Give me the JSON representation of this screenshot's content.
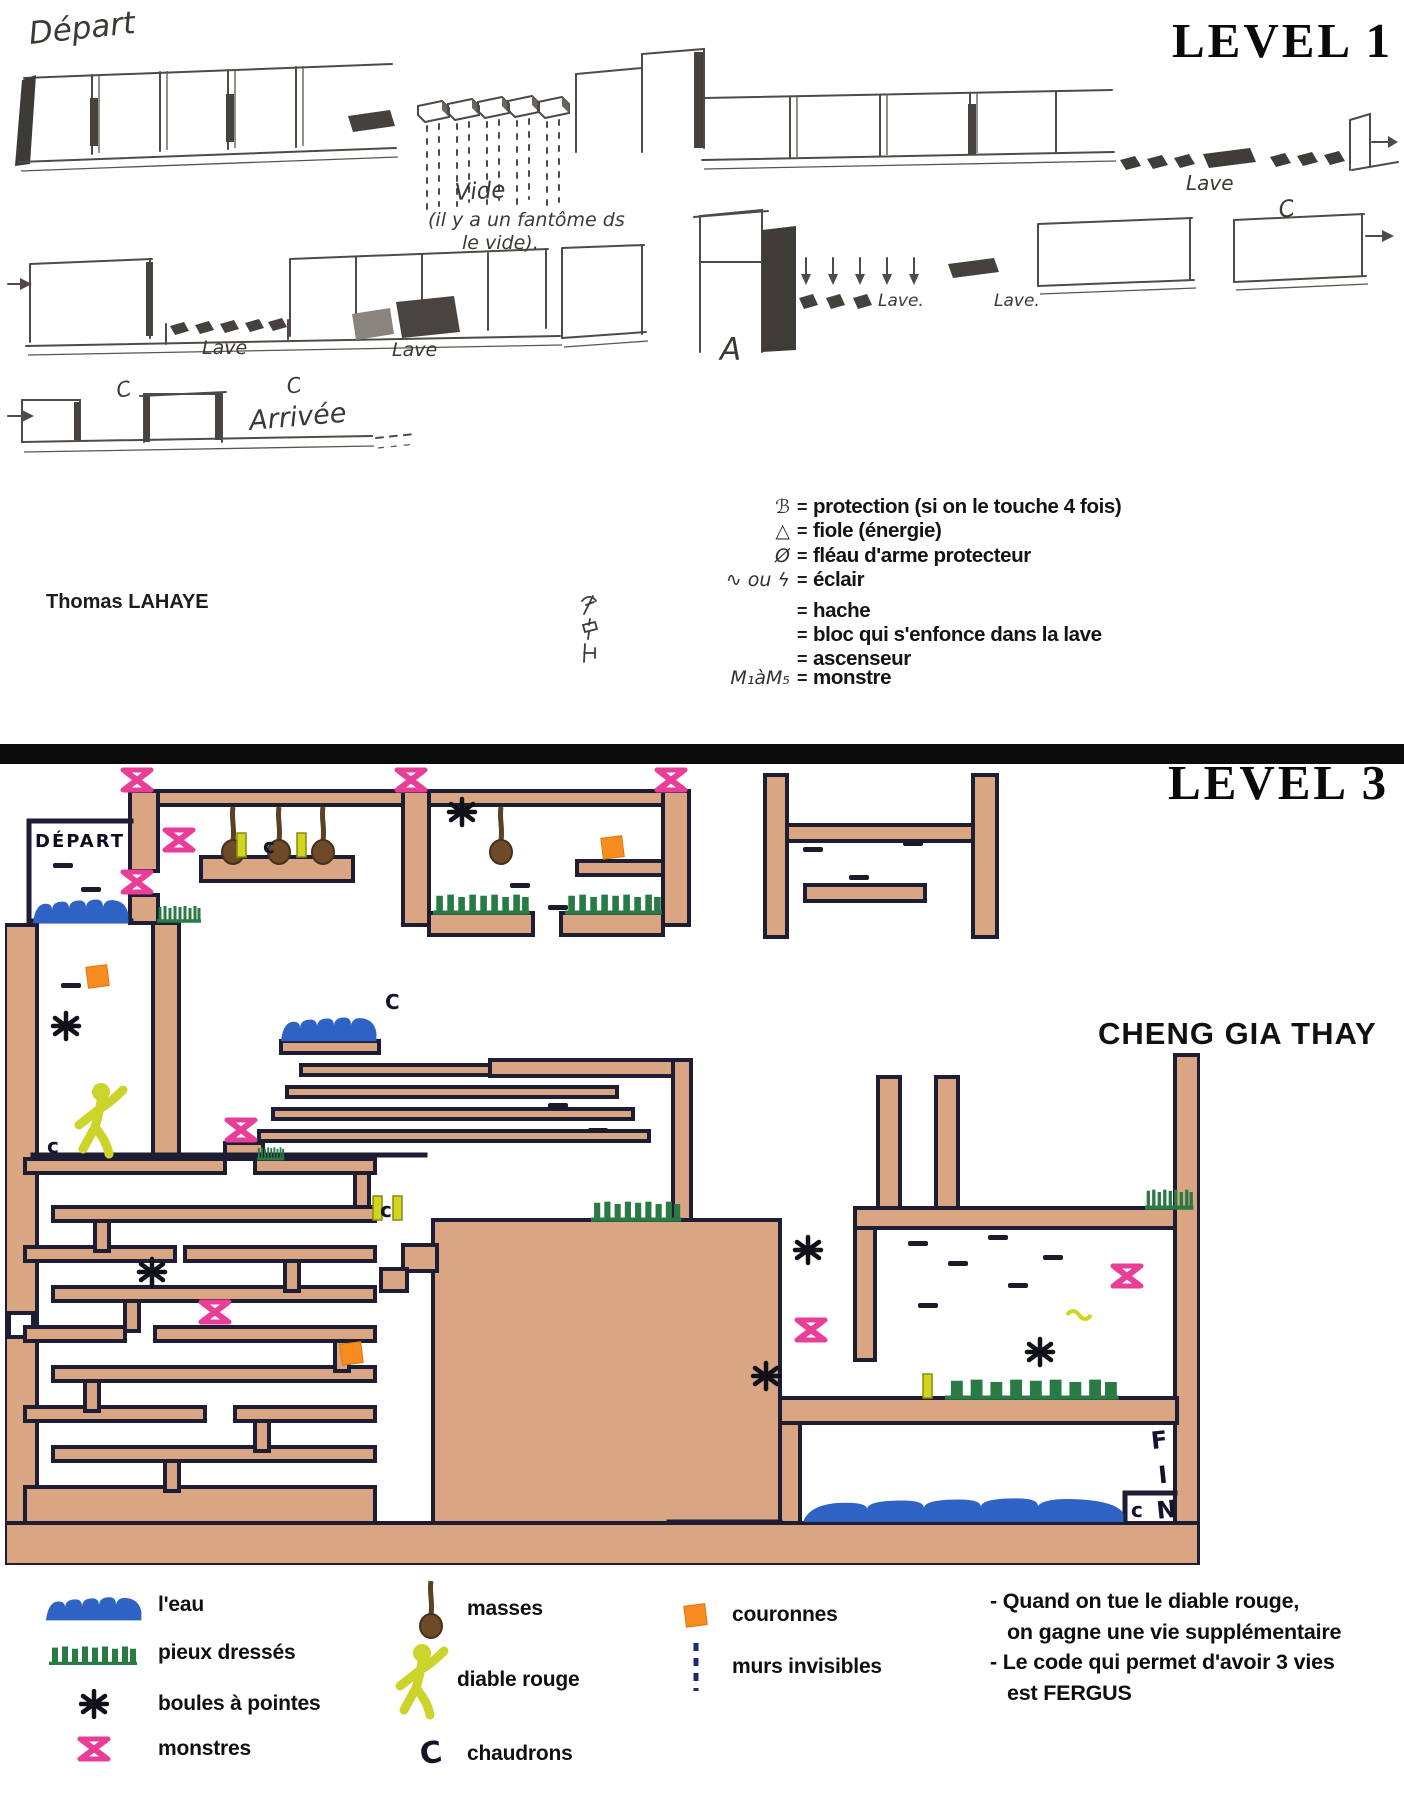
{
  "palette": {
    "wall_tan": "#d9a583",
    "ink_outline": "#1d1d33",
    "pencil_gray": "#4f4a45",
    "monster_pink": "#e93e97",
    "spikes_green": "#2a7a45",
    "water_blue": "#2e62c5",
    "crown_orange": "#f68b20",
    "devil_yellow": "#ccd32b",
    "mace_brown": "#6e4a29",
    "divider_black": "#0c0c0c"
  },
  "level1": {
    "title": "LEVEL 1",
    "author": "Thomas LAHAYE",
    "labels": {
      "depart": "Départ",
      "vide": "Vide",
      "vide_note1": "(il y a un fantôme ds",
      "vide_note2": "le vide).",
      "lave_row1": "Lave",
      "lave_row2a": "Lave",
      "lave_row2b": "Lave",
      "lave_row2c": "Lave.",
      "lave_row2d": "Lave.",
      "marker_a": "A",
      "cauldron_row2": "C",
      "cauldron_row3a": "C",
      "cauldron_row3b": "C",
      "arrivee": "Arrivée"
    },
    "legend": {
      "eq": "=",
      "items": [
        {
          "symbol": "ℬ",
          "label": "protection (si on le touche 4 fois)"
        },
        {
          "symbol": "△",
          "label": "fiole (énergie)"
        },
        {
          "symbol": "Ø",
          "label": "fléau d'arme protecteur"
        },
        {
          "symbol": "∿ ou ϟ",
          "label": "éclair"
        },
        {
          "symbol": "",
          "icon": "axe-sym",
          "label": "hache"
        },
        {
          "symbol": "",
          "icon": "sinking-block-sym",
          "label": "bloc qui s'enfonce dans la lave"
        },
        {
          "symbol": "",
          "icon": "elevator-sym",
          "label": "ascenseur"
        },
        {
          "symbol": "M₁àM₅",
          "label": "monstre"
        }
      ]
    }
  },
  "level3": {
    "title": "LEVEL 3",
    "author": "CHENG GIA THAY",
    "labels": {
      "depart": "DÉPART",
      "fin": "FIN",
      "c_shelf": "c",
      "c_pool": "C",
      "c_figure": "c",
      "c_stairs": "c",
      "c_fin": "c"
    },
    "legend": {
      "cauldron_glyph": "C",
      "items_col1": [
        {
          "icon": "water",
          "label": "l'eau"
        },
        {
          "icon": "spikes",
          "label": "pieux dressés"
        },
        {
          "icon": "spike-ball",
          "label": "boules à pointes"
        },
        {
          "icon": "monster",
          "label": "monstres"
        }
      ],
      "items_col2": [
        {
          "icon": "mace",
          "label": "masses"
        },
        {
          "icon": "red-devil",
          "label": "diable rouge"
        },
        {
          "icon": "cauldron",
          "label": "chaudrons"
        }
      ],
      "items_col3": [
        {
          "icon": "crown",
          "label": "couronnes"
        },
        {
          "icon": "invisible-wall",
          "label": "murs invisibles"
        }
      ],
      "notes": [
        "- Quand on tue le diable rouge,",
        "on gagne une vie supplémentaire",
        "- Le code qui permet d'avoir 3 vies",
        "est FERGUS"
      ]
    }
  }
}
